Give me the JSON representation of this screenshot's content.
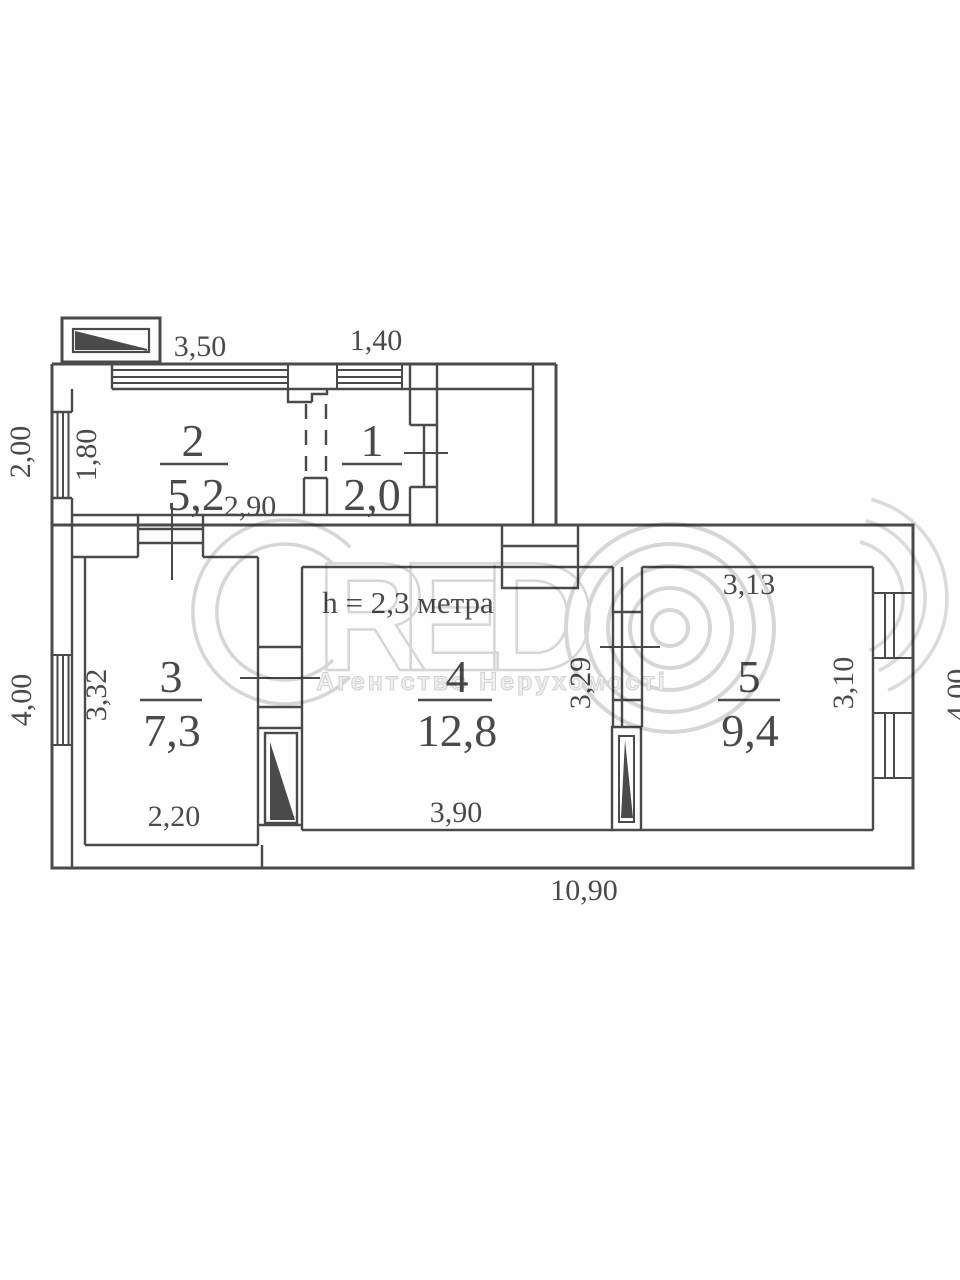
{
  "plan": {
    "height_note": "h = 2,3 метра",
    "dimensions": {
      "annex_top_width": "3,50",
      "room1_top_width": "1,40",
      "annex_left_height": "2,00",
      "room2_window_width": "1,80",
      "room2_width": "2,90",
      "room3_window_height": "3,32",
      "main_left_height": "4,00",
      "room3_width": "2,20",
      "room4_width": "3,90",
      "room4_right_height": "3,29",
      "room5_top_width": "3,13",
      "room5_window_height": "3,10",
      "main_right_height": "4,00",
      "main_bottom_width": "10,90"
    },
    "rooms": [
      {
        "number": "2",
        "area": "5,2"
      },
      {
        "number": "1",
        "area": "2,0"
      },
      {
        "number": "3",
        "area": "7,3"
      },
      {
        "number": "4",
        "area": "12,8"
      },
      {
        "number": "5",
        "area": "9,4"
      }
    ],
    "watermark": {
      "letter_r": "R",
      "letter_e": "E",
      "letter_d": "D",
      "agency": "Агентство Нерухомості"
    }
  }
}
